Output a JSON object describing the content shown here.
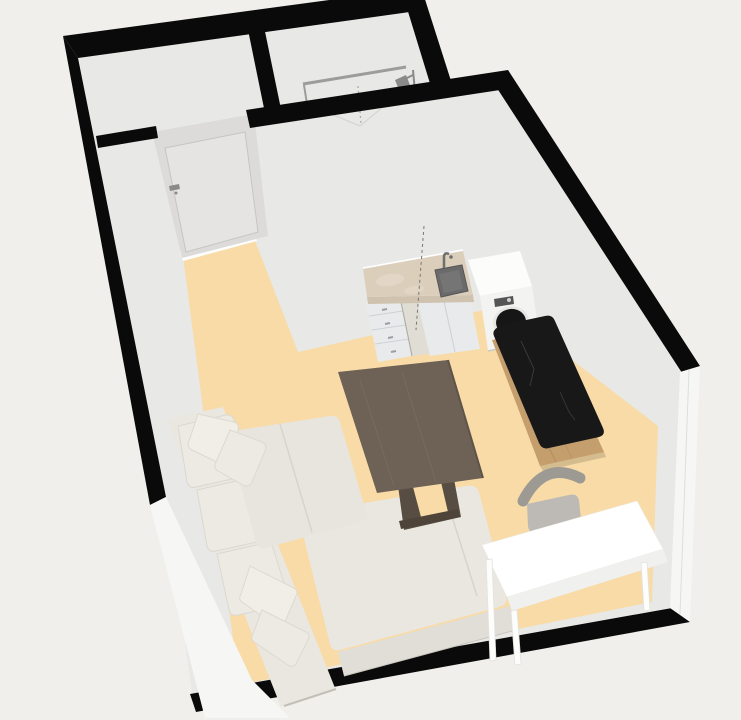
{
  "scene": {
    "title": "Studio apartment 3D floor plan render",
    "view": "top-down perspective"
  },
  "palette": {
    "background": "#f0efeb",
    "wallTop": "#0a0a0a",
    "wallInterior": "#e8e8e6",
    "wallExterior": "#f6f6f4",
    "doorFace": "#dcdbd9",
    "doorLeaf": "#e5e4e2",
    "sill": "#fdfdfc",
    "floor": "#f8dba6",
    "metal": "#8a8a8a",
    "railGray": "#9c9c9c",
    "sofaBody": "#eae7e1",
    "sofaFront": "#e1ded7",
    "sofaCushion": "#edeae3",
    "sofaSeat": "#e8e5de",
    "sofaSeam": "#d7d4cc",
    "pillow": "#f1eee7",
    "tableTop": "#6e6156",
    "tableLeg": "#584d42",
    "tableFoot": "#4e443a",
    "counterTop": "#dbcfbc",
    "counterEdge": "#cfc2ae",
    "cabinet": "#e9eaeb",
    "cabinetLine": "#cdd1d3",
    "handle": "#9aa0a3",
    "sink": "#6a6a6a",
    "sinkInner": "#757575",
    "washerBody": "#fcfcfb",
    "washerFront": "#f3f3f1",
    "washerDoor": "#161616",
    "washerPanel": "#555555",
    "islandWood": "#c59e6e",
    "islandTop": "#181818",
    "islandVein": "#3d3d3d",
    "chairBack": "#9d9a94",
    "chairSeat": "#bdbab5",
    "deskTop": "#ffffff",
    "deskSide": "#f0f0ee",
    "gapShade": "#e0ddd4"
  },
  "rooms": [
    {
      "id": "hallway",
      "label": "Hallway"
    },
    {
      "id": "bathroom",
      "label": "Bathroom",
      "fixtures": [
        "shower"
      ]
    },
    {
      "id": "living-room",
      "label": "Living room with kitchenette"
    }
  ],
  "furniture": [
    {
      "id": "interior-door",
      "label": "Interior door"
    },
    {
      "id": "shower",
      "label": "Shower"
    },
    {
      "id": "kitchen-counter",
      "label": "Kitchen counter with sink and drawers"
    },
    {
      "id": "washing-machine",
      "label": "Washing machine"
    },
    {
      "id": "kitchen-island",
      "label": "Wooden island with black stone top"
    },
    {
      "id": "dining-table",
      "label": "Dining table"
    },
    {
      "id": "chair",
      "label": "Chair"
    },
    {
      "id": "desk",
      "label": "White desk"
    },
    {
      "id": "corner-sofa",
      "label": "Corner sofa with chaise"
    }
  ]
}
